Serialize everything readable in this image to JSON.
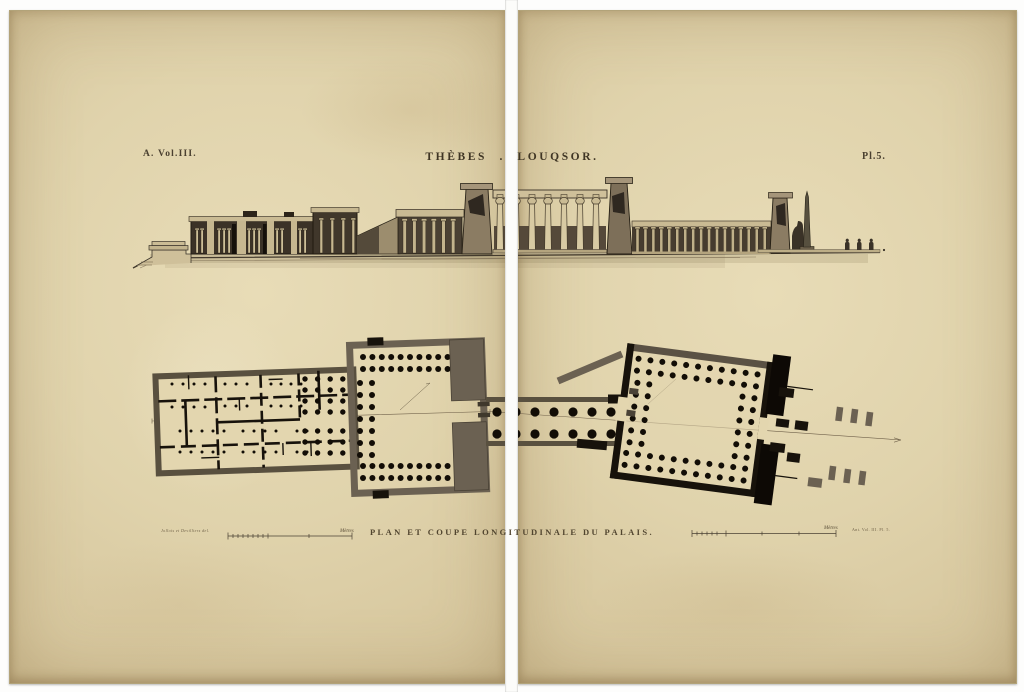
{
  "page": {
    "paper_color": "#ddd0a8",
    "ink_color": "#2a241c",
    "wall_gray": "#6b6152",
    "seam_color": "#fcfcfa"
  },
  "header": {
    "volume": "A. Vol.III.",
    "title": "THÈBES . LOUQSOR.",
    "plate": "Pl.5."
  },
  "caption": "PLAN ET COUPE LONGITUDINALE DU PALAIS.",
  "credits": {
    "left": "Jollois et Devilliers del.",
    "right": "Ant. Vol. III. Pl. 5."
  },
  "scales": {
    "left_label": "Mètres",
    "right_label": "Mètres"
  }
}
